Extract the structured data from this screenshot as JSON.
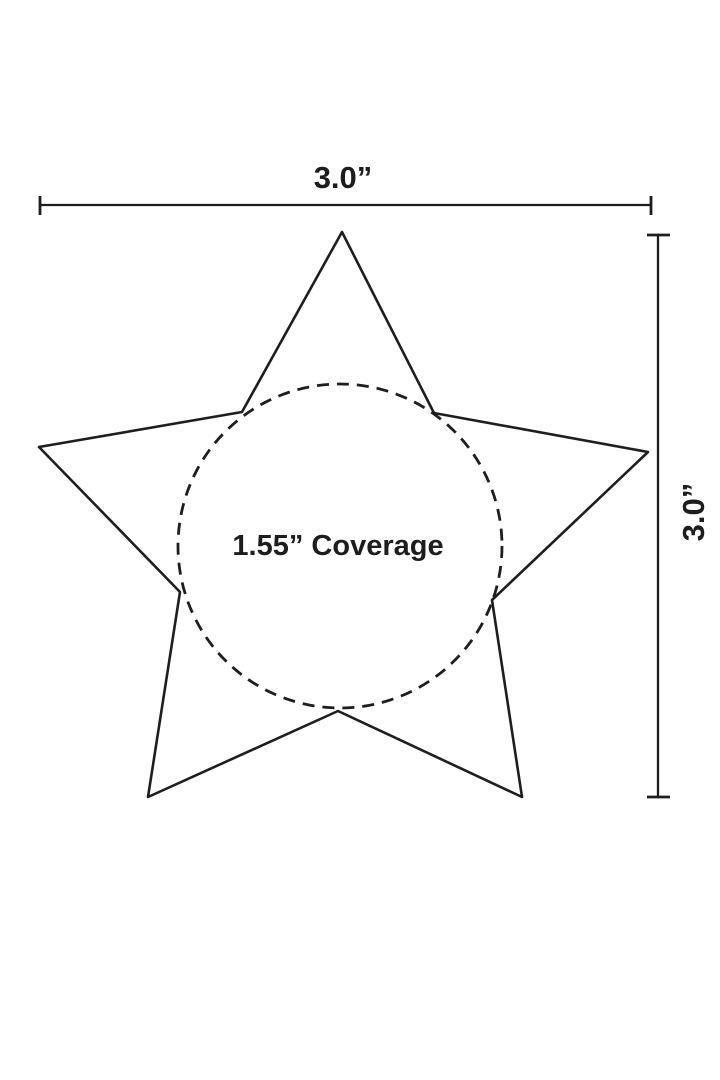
{
  "diagram": {
    "width_label": "3.0”",
    "height_label": "3.0”",
    "coverage_label": "1.55” Coverage",
    "line_color": "#1e1e1e",
    "text_color": "#1d1d1d",
    "background_color": "#ffffff"
  }
}
